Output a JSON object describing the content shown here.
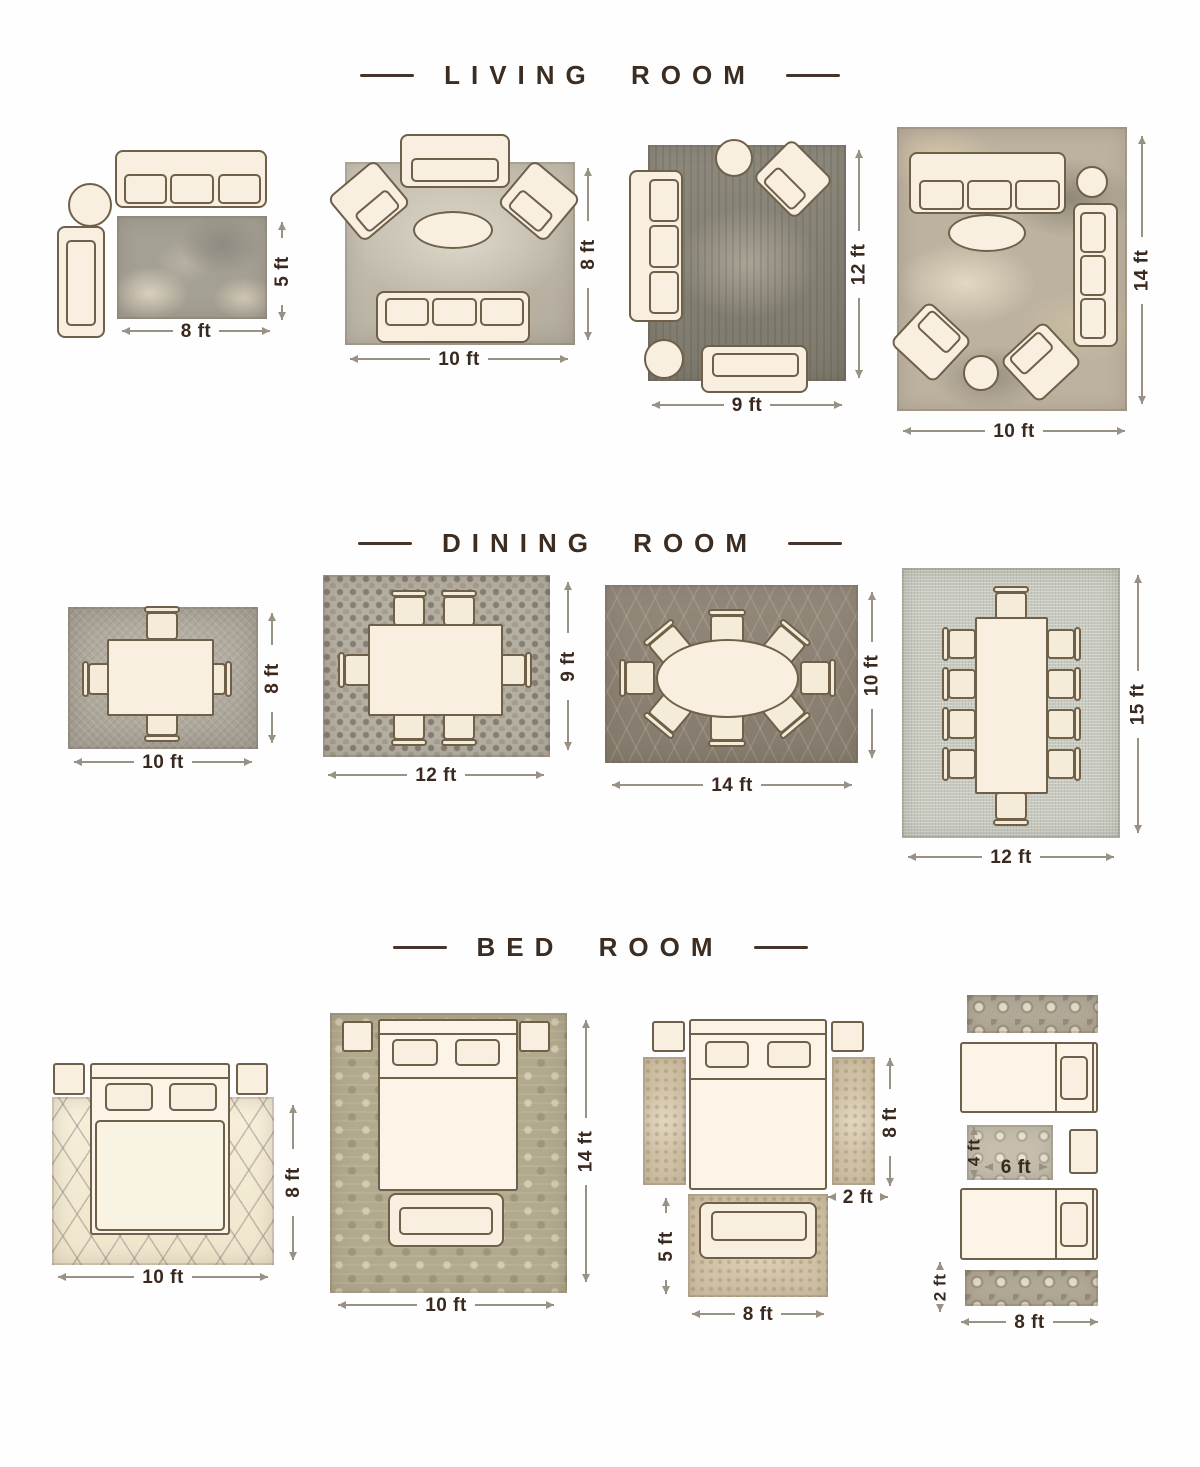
{
  "colors": {
    "background": "#fefefe",
    "title_text": "#3c2d22",
    "dimension_text": "#39291f",
    "dimension_line": "#9a9185",
    "furniture_fill": "#f8efe0",
    "furniture_outline": "#6e6049"
  },
  "sections": [
    {
      "id": "living-room",
      "title": "LIVING ROOM",
      "layouts": [
        {
          "width": "8 ft",
          "height": "5 ft"
        },
        {
          "width": "10 ft",
          "height": "8 ft"
        },
        {
          "width": "9 ft",
          "height": "12 ft"
        },
        {
          "width": "10 ft",
          "height": "14 ft"
        }
      ]
    },
    {
      "id": "dining-room",
      "title": "DINING ROOM",
      "layouts": [
        {
          "width": "10 ft",
          "height": "8 ft"
        },
        {
          "width": "12 ft",
          "height": "9 ft"
        },
        {
          "width": "14 ft",
          "height": "10 ft"
        },
        {
          "width": "12 ft",
          "height": "15 ft"
        }
      ]
    },
    {
      "id": "bed-room",
      "title": "BED ROOM",
      "layouts": [
        {
          "width": "10 ft",
          "height": "8 ft"
        },
        {
          "width": "10 ft",
          "height": "14 ft"
        },
        {
          "runner_height": "8 ft",
          "runner_width": "2 ft",
          "foot_height": "5 ft",
          "foot_width": "8 ft"
        },
        {
          "mid_height": "4 ft",
          "mid_width": "6 ft",
          "runner_width": "2 ft",
          "width": "8 ft"
        }
      ]
    }
  ]
}
